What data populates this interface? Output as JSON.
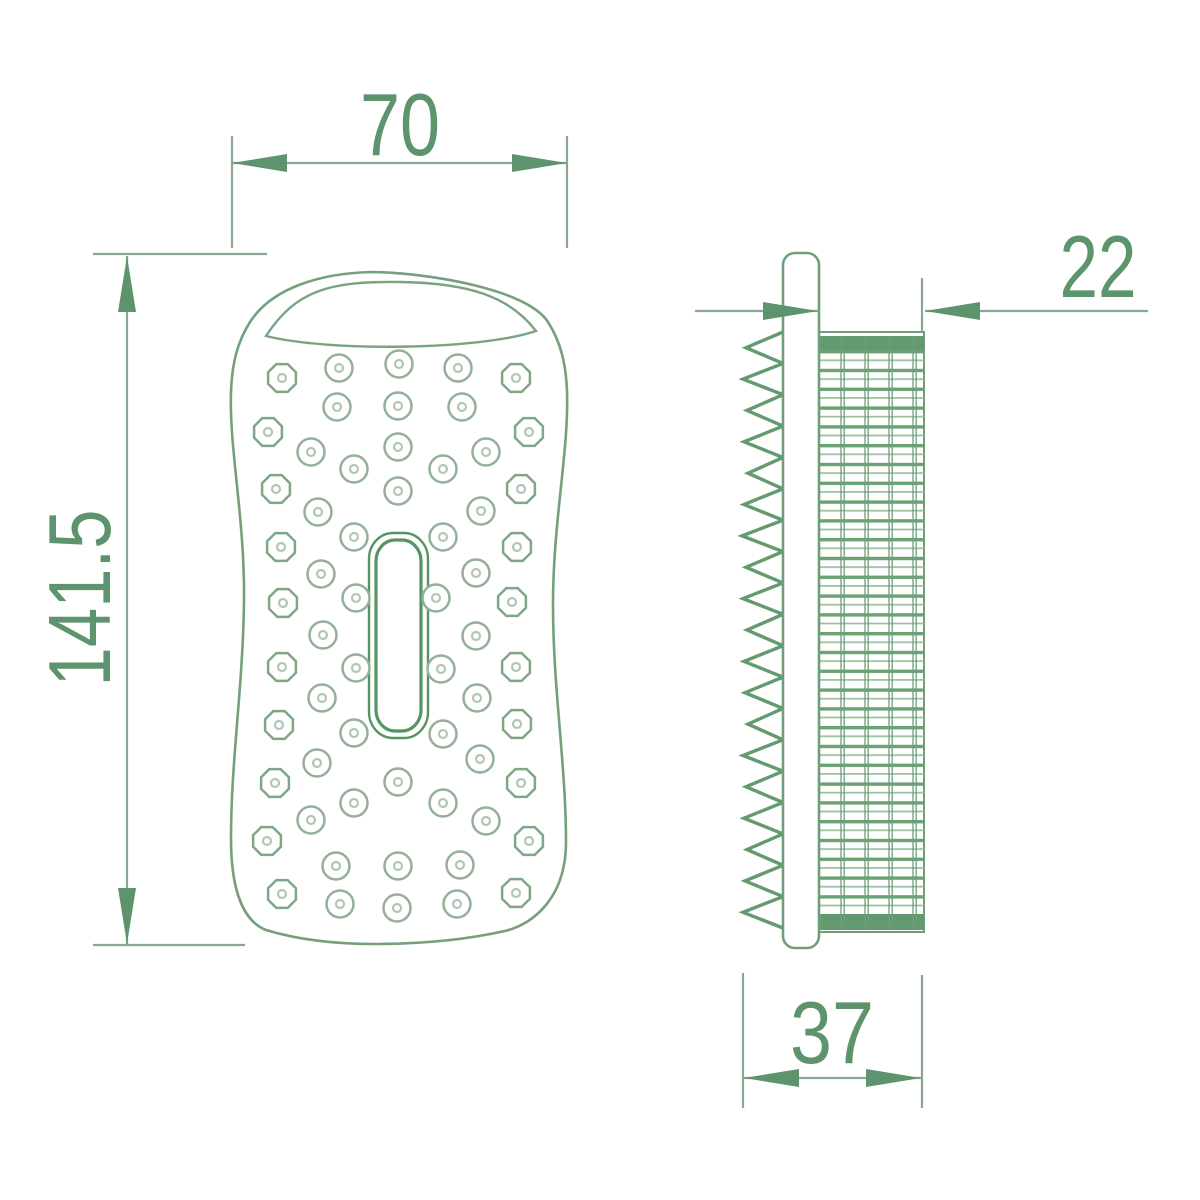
{
  "drawing": {
    "type": "technical-orthographic-drawing",
    "subject": "massage brush — front and side views with dimensions",
    "colors": {
      "accent": "#5d946d",
      "thin_line": "#8ba78f",
      "outline": "#74a07c",
      "slot": "#55955f",
      "slat_dark": "#6aa274",
      "slat_light": "#9fc0a4",
      "band": "#62996e",
      "nub_octagon": "#7fa687",
      "nub_circle": "#93b098",
      "nub_center": "#b2c8b6"
    },
    "dims": {
      "front_width": "70",
      "front_height": "141.5",
      "side_body_depth": "22",
      "side_total_depth": "37"
    },
    "front_view": {
      "nubs": [
        {
          "t": "o",
          "x": 282,
          "y": 378
        },
        {
          "t": "c",
          "x": 339,
          "y": 368
        },
        {
          "t": "c",
          "x": 399,
          "y": 364
        },
        {
          "t": "c",
          "x": 458,
          "y": 368
        },
        {
          "t": "o",
          "x": 516,
          "y": 378
        },
        {
          "t": "c",
          "x": 337,
          "y": 407
        },
        {
          "t": "c",
          "x": 398,
          "y": 406
        },
        {
          "t": "c",
          "x": 462,
          "y": 407
        },
        {
          "t": "o",
          "x": 268,
          "y": 432
        },
        {
          "t": "o",
          "x": 529,
          "y": 432
        },
        {
          "t": "c",
          "x": 311,
          "y": 452
        },
        {
          "t": "c",
          "x": 398,
          "y": 447
        },
        {
          "t": "c",
          "x": 486,
          "y": 452
        },
        {
          "t": "c",
          "x": 354,
          "y": 469
        },
        {
          "t": "c",
          "x": 443,
          "y": 469
        },
        {
          "t": "o",
          "x": 276,
          "y": 489
        },
        {
          "t": "c",
          "x": 398,
          "y": 491
        },
        {
          "t": "o",
          "x": 521,
          "y": 489
        },
        {
          "t": "c",
          "x": 318,
          "y": 512
        },
        {
          "t": "c",
          "x": 481,
          "y": 511
        },
        {
          "t": "c",
          "x": 354,
          "y": 537
        },
        {
          "t": "c",
          "x": 443,
          "y": 537
        },
        {
          "t": "o",
          "x": 281,
          "y": 547
        },
        {
          "t": "o",
          "x": 517,
          "y": 547
        },
        {
          "t": "c",
          "x": 321,
          "y": 574
        },
        {
          "t": "c",
          "x": 476,
          "y": 573
        },
        {
          "t": "o",
          "x": 283,
          "y": 603
        },
        {
          "t": "c",
          "x": 356,
          "y": 598
        },
        {
          "t": "c",
          "x": 436,
          "y": 598
        },
        {
          "t": "o",
          "x": 512,
          "y": 602
        },
        {
          "t": "c",
          "x": 323,
          "y": 635
        },
        {
          "t": "c",
          "x": 476,
          "y": 636
        },
        {
          "t": "o",
          "x": 282,
          "y": 667
        },
        {
          "t": "c",
          "x": 356,
          "y": 668
        },
        {
          "t": "c",
          "x": 441,
          "y": 669
        },
        {
          "t": "o",
          "x": 516,
          "y": 667
        },
        {
          "t": "c",
          "x": 322,
          "y": 698
        },
        {
          "t": "c",
          "x": 477,
          "y": 698
        },
        {
          "t": "o",
          "x": 279,
          "y": 725
        },
        {
          "t": "o",
          "x": 517,
          "y": 724
        },
        {
          "t": "c",
          "x": 354,
          "y": 733
        },
        {
          "t": "c",
          "x": 443,
          "y": 734
        },
        {
          "t": "c",
          "x": 317,
          "y": 763
        },
        {
          "t": "c",
          "x": 480,
          "y": 759
        },
        {
          "t": "o",
          "x": 275,
          "y": 783
        },
        {
          "t": "c",
          "x": 398,
          "y": 782
        },
        {
          "t": "o",
          "x": 521,
          "y": 783
        },
        {
          "t": "c",
          "x": 354,
          "y": 803
        },
        {
          "t": "c",
          "x": 443,
          "y": 803
        },
        {
          "t": "c",
          "x": 311,
          "y": 820
        },
        {
          "t": "c",
          "x": 486,
          "y": 821
        },
        {
          "t": "o",
          "x": 267,
          "y": 841
        },
        {
          "t": "o",
          "x": 529,
          "y": 841
        },
        {
          "t": "c",
          "x": 336,
          "y": 866
        },
        {
          "t": "c",
          "x": 398,
          "y": 866
        },
        {
          "t": "c",
          "x": 460,
          "y": 865
        },
        {
          "t": "o",
          "x": 282,
          "y": 894
        },
        {
          "t": "o",
          "x": 516,
          "y": 893
        },
        {
          "t": "c",
          "x": 340,
          "y": 904
        },
        {
          "t": "c",
          "x": 397,
          "y": 908
        },
        {
          "t": "c",
          "x": 457,
          "y": 904
        }
      ]
    },
    "side_view": {
      "bristles": {
        "base_x": 783,
        "top": 332,
        "bottom": 928,
        "tips_x": [
          746,
          743,
          747,
          744,
          748,
          744,
          742,
          746,
          743,
          747,
          744,
          745,
          748,
          743,
          746,
          744,
          747,
          745,
          743
        ]
      }
    }
  }
}
